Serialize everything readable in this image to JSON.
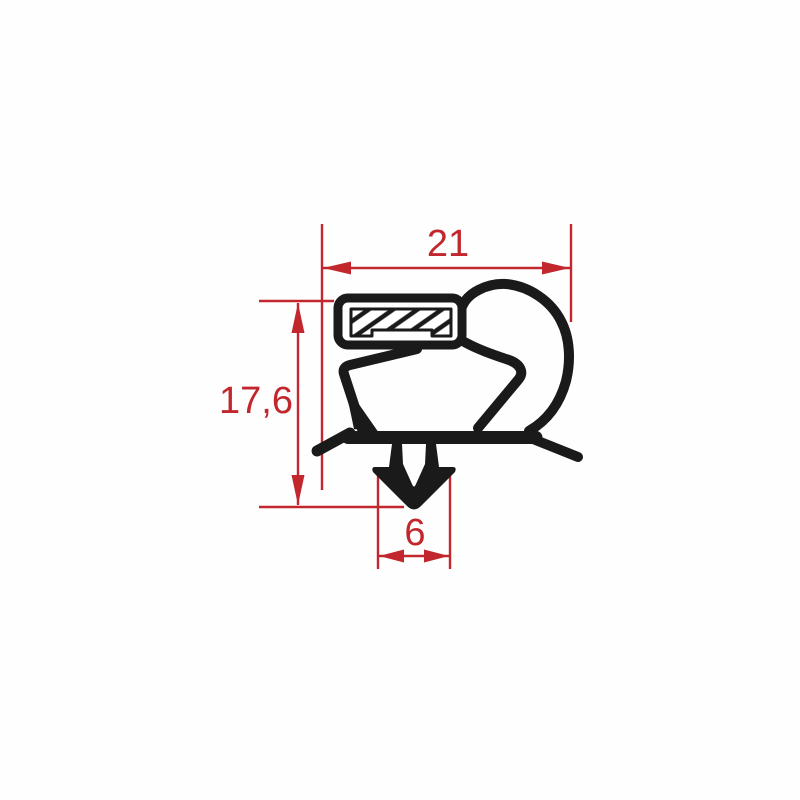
{
  "drawing": {
    "title": "gasket profile cross-section",
    "background": "#ffffff",
    "profile_color": "#1a1a1a",
    "dimension_color": "#c1272d",
    "dimensions": {
      "width": {
        "label": "21",
        "orientation": "horizontal"
      },
      "height": {
        "label": "17,6",
        "orientation": "vertical"
      },
      "dart_width": {
        "label": "6",
        "orientation": "horizontal"
      }
    }
  }
}
